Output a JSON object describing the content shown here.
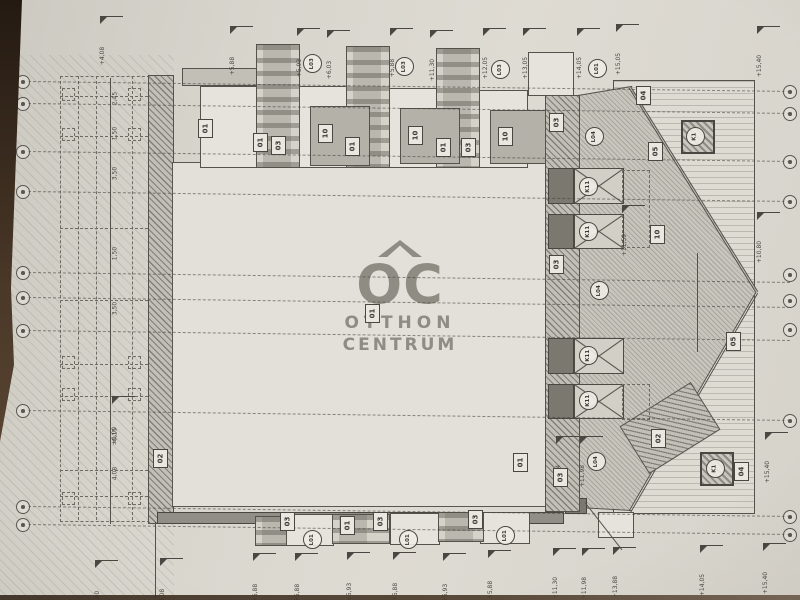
{
  "watermark": {
    "logo": "OC",
    "line1": "OTTHON",
    "line2": "CENTRUM"
  },
  "colors": {
    "paper": "#d8d5cd",
    "ink": "#55524c",
    "fill_gray": "#b4b1a9",
    "fill_dark": "#7b786f",
    "watermark_gray": "#807c73",
    "table_edge": "#3a2c1e"
  },
  "grid": {
    "axis_y_left": [
      81,
      103,
      151,
      191,
      272,
      297,
      330,
      410,
      506,
      524
    ],
    "bubbles_right_y": [
      91,
      113,
      161,
      201,
      274,
      300,
      329,
      420,
      516,
      534
    ]
  },
  "labels": {
    "boxes": [
      {
        "t": "01",
        "x": 205,
        "y": 128
      },
      {
        "t": "01",
        "x": 260,
        "y": 142
      },
      {
        "t": "03",
        "x": 278,
        "y": 145
      },
      {
        "t": "10",
        "x": 325,
        "y": 133
      },
      {
        "t": "01",
        "x": 352,
        "y": 146
      },
      {
        "t": "10",
        "x": 415,
        "y": 135
      },
      {
        "t": "01",
        "x": 443,
        "y": 147
      },
      {
        "t": "03",
        "x": 468,
        "y": 147
      },
      {
        "t": "10",
        "x": 505,
        "y": 136
      },
      {
        "t": "04",
        "x": 643,
        "y": 95
      },
      {
        "t": "05",
        "x": 655,
        "y": 151
      },
      {
        "t": "10",
        "x": 657,
        "y": 234
      },
      {
        "t": "05",
        "x": 733,
        "y": 341
      },
      {
        "t": "04",
        "x": 741,
        "y": 471
      },
      {
        "t": "02",
        "x": 658,
        "y": 438
      },
      {
        "t": "03",
        "x": 556,
        "y": 122
      },
      {
        "t": "03",
        "x": 556,
        "y": 264
      },
      {
        "t": "03",
        "x": 560,
        "y": 477
      },
      {
        "t": "01",
        "x": 372,
        "y": 313
      },
      {
        "t": "01",
        "x": 520,
        "y": 462
      },
      {
        "t": "02",
        "x": 160,
        "y": 458
      },
      {
        "t": "03",
        "x": 287,
        "y": 521
      },
      {
        "t": "01",
        "x": 347,
        "y": 525
      },
      {
        "t": "03",
        "x": 380,
        "y": 521
      },
      {
        "t": "03",
        "x": 475,
        "y": 519
      }
    ],
    "circles": [
      {
        "t": "L03",
        "x": 312,
        "y": 63
      },
      {
        "t": "L03",
        "x": 404,
        "y": 66
      },
      {
        "t": "L03",
        "x": 500,
        "y": 69
      },
      {
        "t": "L01",
        "x": 597,
        "y": 68
      },
      {
        "t": "L04",
        "x": 594,
        "y": 136
      },
      {
        "t": "K11",
        "x": 588,
        "y": 186
      },
      {
        "t": "K11",
        "x": 588,
        "y": 231
      },
      {
        "t": "L04",
        "x": 599,
        "y": 290
      },
      {
        "t": "K11",
        "x": 588,
        "y": 355
      },
      {
        "t": "K11",
        "x": 588,
        "y": 400
      },
      {
        "t": "L04",
        "x": 596,
        "y": 461
      },
      {
        "t": "K1",
        "x": 695,
        "y": 136
      },
      {
        "t": "K1",
        "x": 715,
        "y": 468
      },
      {
        "t": "L01",
        "x": 312,
        "y": 539
      },
      {
        "t": "L01",
        "x": 408,
        "y": 539
      },
      {
        "t": "L01",
        "x": 505,
        "y": 535
      }
    ]
  },
  "markers": [
    {
      "x": 100,
      "y": 16,
      "t": "+4,08"
    },
    {
      "x": 230,
      "y": 26,
      "t": "+5,88"
    },
    {
      "x": 297,
      "y": 28,
      "t": "+5,93"
    },
    {
      "x": 327,
      "y": 30,
      "t": "+6,03"
    },
    {
      "x": 390,
      "y": 28,
      "t": "+5,88"
    },
    {
      "x": 430,
      "y": 30,
      "t": "+11,30"
    },
    {
      "x": 483,
      "y": 28,
      "t": "+12,05"
    },
    {
      "x": 523,
      "y": 28,
      "t": "+13,05"
    },
    {
      "x": 577,
      "y": 28,
      "t": "+14,05"
    },
    {
      "x": 616,
      "y": 24,
      "t": "+15,05"
    },
    {
      "x": 757,
      "y": 26,
      "t": "+15,40"
    },
    {
      "x": 95,
      "y": 560,
      "t": "±0,00"
    },
    {
      "x": 160,
      "y": 558,
      "t": "+4,08"
    },
    {
      "x": 253,
      "y": 553,
      "t": "+5,88"
    },
    {
      "x": 295,
      "y": 553,
      "t": "+5,88"
    },
    {
      "x": 347,
      "y": 552,
      "t": "+5,93"
    },
    {
      "x": 393,
      "y": 552,
      "t": "+5,88"
    },
    {
      "x": 443,
      "y": 553,
      "t": "+5,93"
    },
    {
      "x": 488,
      "y": 550,
      "t": "+5,88"
    },
    {
      "x": 553,
      "y": 548,
      "t": "+11,30"
    },
    {
      "x": 582,
      "y": 548,
      "t": "+11,98"
    },
    {
      "x": 613,
      "y": 547,
      "t": "+13,88"
    },
    {
      "x": 700,
      "y": 545,
      "t": "+14,05"
    },
    {
      "x": 763,
      "y": 543,
      "t": "+15,40"
    },
    {
      "x": 757,
      "y": 212,
      "t": "+10,80"
    },
    {
      "x": 765,
      "y": 432,
      "t": "+15,40"
    },
    {
      "x": 556,
      "y": 436,
      "t": "+11,04"
    },
    {
      "x": 580,
      "y": 436,
      "t": "+11,98"
    },
    {
      "x": 622,
      "y": 205,
      "t": "+11,59"
    },
    {
      "x": 112,
      "y": 396,
      "t": "±0,00"
    }
  ],
  "dimension_texts": [
    {
      "x": 112,
      "y": 95,
      "t": "2,45"
    },
    {
      "x": 112,
      "y": 130,
      "t": "1,50"
    },
    {
      "x": 112,
      "y": 170,
      "t": "3,50"
    },
    {
      "x": 112,
      "y": 250,
      "t": "1,50"
    },
    {
      "x": 112,
      "y": 305,
      "t": "3,50"
    },
    {
      "x": 112,
      "y": 432,
      "t": "-0,15"
    },
    {
      "x": 112,
      "y": 470,
      "t": "4,08"
    }
  ]
}
